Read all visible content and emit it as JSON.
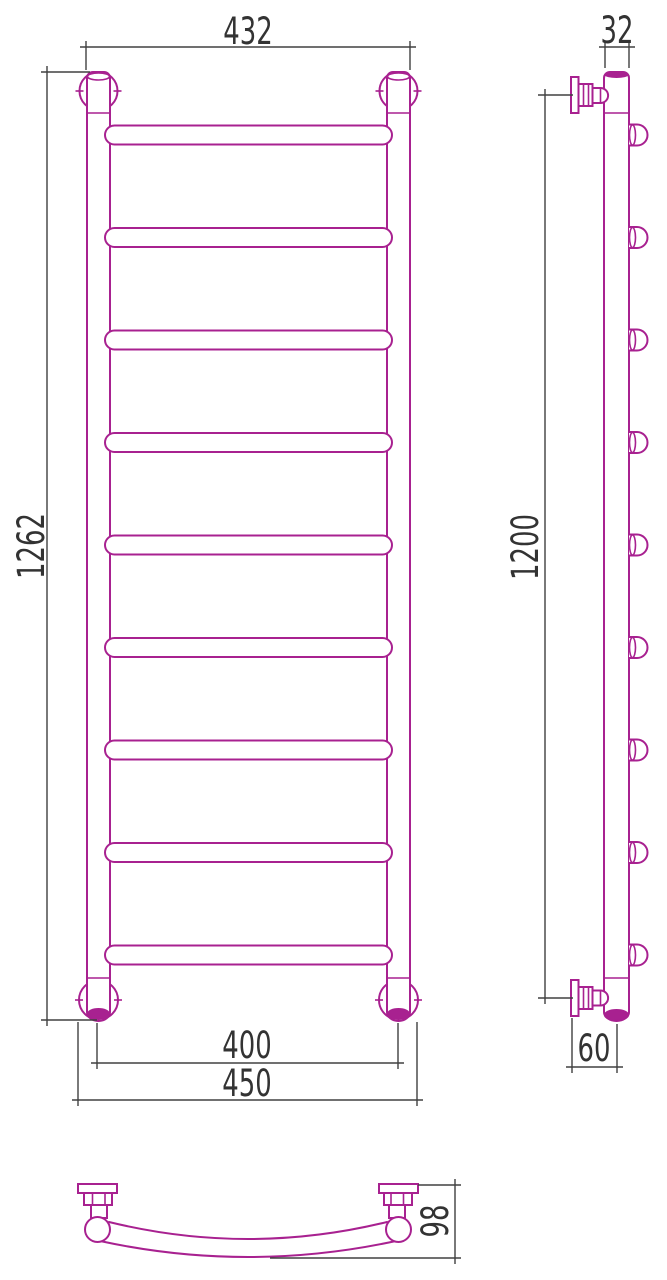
{
  "drawing": {
    "colors": {
      "product": "#a82190",
      "dimension": "#404040",
      "dimension_text": "#333333"
    },
    "rung_count": 9,
    "dimensions": {
      "overall_width": "432",
      "overall_height": "1262",
      "bottom_tube_spacing": "400",
      "bottom_outer_width": "450",
      "tube_diameter": "32",
      "mount_height": "1200",
      "wall_offset": "60",
      "depth": "98"
    }
  }
}
